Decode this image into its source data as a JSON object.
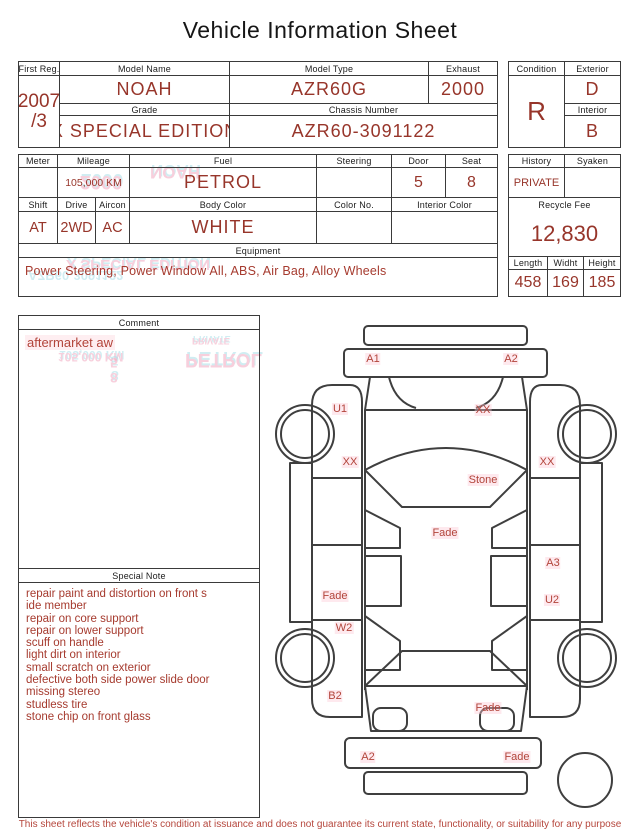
{
  "title": "Vehicle Information Sheet",
  "registration": {
    "first_reg_label": "First Reg.",
    "first_reg_year": "2007",
    "first_reg_month": "/3",
    "model_name_label": "Model Name",
    "model_name": "NOAH",
    "model_type_label": "Model Type",
    "model_type": "AZR60G",
    "exhaust_label": "Exhaust",
    "exhaust": "2000",
    "grade_label": "Grade",
    "grade": "X SPECIAL EDITION",
    "chassis_number_label": "Chassis Number",
    "chassis_number": "AZR60-3091122",
    "condition_label": "Condition",
    "condition": "R",
    "exterior_label": "Exterior",
    "exterior": "D",
    "interior_label": "Interior",
    "interior": "B"
  },
  "details": {
    "meter_label": "Meter",
    "meter": "",
    "mileage_label": "Mileage",
    "mileage": "105,000 KM",
    "fuel_label": "Fuel",
    "fuel": "PETROL",
    "steering_label": "Steering",
    "steering": "",
    "door_label": "Door",
    "door": "5",
    "seat_label": "Seat",
    "seat": "8",
    "shift_label": "Shift",
    "shift": "AT",
    "drive_label": "Drive",
    "drive": "2WD",
    "aircon_label": "Aircon",
    "aircon": "AC",
    "body_color_label": "Body Color",
    "body_color": "WHITE",
    "color_no_label": "Color No.",
    "color_no": "",
    "interior_color_label": "Interior Color",
    "interior_color": "",
    "equipment_label": "Equipment",
    "equipment": "Power Steering, Power Window  All, ABS, Air Bag, Alloy Wheels",
    "history_label": "History",
    "history": "PRIVATE",
    "syaken_label": "Syaken",
    "syaken": "",
    "recycle_fee_label": "Recycle Fee",
    "recycle_fee": "12,830",
    "length_label": "Length",
    "length": "458",
    "width_label": "Widht",
    "width": "169",
    "height_label": "Height",
    "height": "185"
  },
  "comment": {
    "label": "Comment",
    "text": "aftermarket aw"
  },
  "special_note": {
    "label": "Special Note",
    "lines": [
      "repair paint and distortion on front s",
      "ide member",
      "repair on core support",
      "repair on lower support",
      "scuff on handle",
      "light dirt on interior",
      "small scratch on exterior",
      "defective both side power slide door",
      "missing stereo",
      "studless tire",
      "stone chip on front glass"
    ]
  },
  "diagram": {
    "labels": [
      {
        "text": "A1"
      },
      {
        "text": "A2"
      },
      {
        "text": "U1"
      },
      {
        "text": "XX"
      },
      {
        "text": "XX"
      },
      {
        "text": "XX"
      },
      {
        "text": "Stone"
      },
      {
        "text": "Fade"
      },
      {
        "text": "A3"
      },
      {
        "text": "Fade"
      },
      {
        "text": "U2"
      },
      {
        "text": "W2"
      },
      {
        "text": "B2"
      },
      {
        "text": "Fade"
      },
      {
        "text": "A2"
      },
      {
        "text": "Fade"
      }
    ]
  },
  "ghost_text": [
    "NOAH",
    "2000",
    "X SPECIAL EDITION",
    "AZR60-3091122",
    "105,000 KM",
    "PETROL",
    "PRIVATE",
    "5",
    "8"
  ],
  "footer": "This sheet reflects the vehicle's condition at issuance and does not guarantee its current state, functionality, or suitability for any purpose",
  "colors": {
    "value_red": "#97352a",
    "note_red": "#a63b2f",
    "label_black": "#1c1c1c",
    "border": "#3a3a3a",
    "ghost_pink": "#f2a9c0",
    "ghost_cyan": "#aadfe8"
  }
}
